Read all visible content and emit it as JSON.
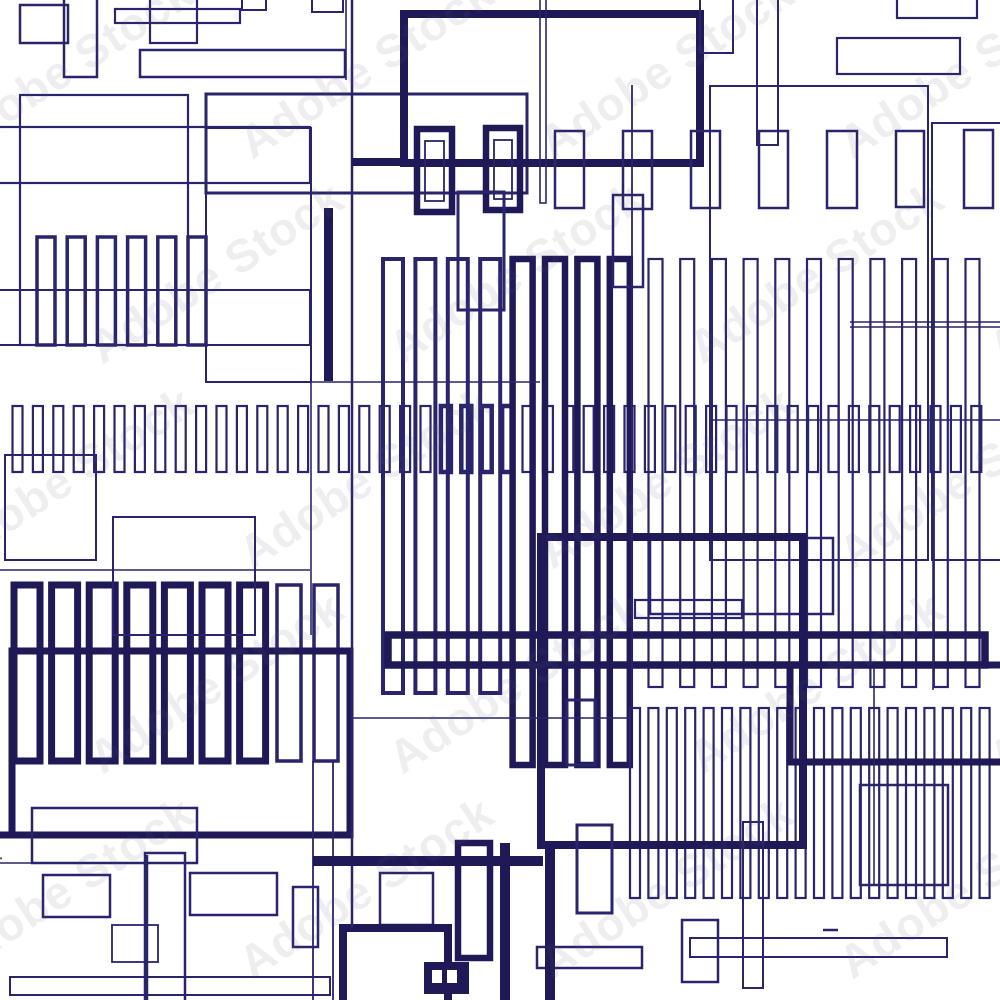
{
  "watermark": {
    "tile_text": "Adobe Stock",
    "credit_text": "Adobe Stock | #250414884"
  },
  "palette": {
    "background": "#ffffff",
    "ink_thin": "#29246b",
    "ink_bold": "#1f1a57",
    "watermark_gray": "#555558"
  },
  "figure": {
    "rects": [
      [
        20,
        5,
        48,
        38,
        2.5
      ],
      [
        64,
        -10,
        33,
        87,
        2.5
      ],
      [
        115,
        9,
        125,
        14,
        2.2
      ],
      [
        150,
        -10,
        47,
        53,
        2.2
      ],
      [
        242,
        -6,
        24,
        16,
        2
      ],
      [
        312,
        -6,
        31,
        18,
        2
      ],
      [
        140,
        50,
        205,
        27,
        2.5
      ],
      [
        20,
        95,
        168,
        250,
        2.2
      ],
      [
        -15,
        127,
        325,
        56,
        2.2
      ],
      [
        -15,
        290,
        325,
        55,
        2
      ],
      [
        206,
        94,
        321,
        99,
        3
      ],
      [
        206,
        128,
        105,
        254,
        2
      ],
      [
        404,
        14,
        296,
        149,
        8
      ],
      [
        417,
        129,
        35,
        83,
        6.5
      ],
      [
        425,
        141,
        19,
        60,
        1.8
      ],
      [
        486,
        128,
        34,
        82,
        6.5
      ],
      [
        494,
        140,
        18,
        59,
        1.8
      ],
      [
        555,
        131,
        29,
        77,
        2.5
      ],
      [
        623,
        131,
        29,
        78,
        2.5
      ],
      [
        691,
        131,
        29,
        77,
        2.5
      ],
      [
        759,
        131,
        29,
        77,
        2.5
      ],
      [
        827,
        131,
        30,
        77,
        2.5
      ],
      [
        896,
        131,
        28,
        76,
        2.5
      ],
      [
        964,
        130,
        29,
        78,
        2.5
      ],
      [
        458,
        192,
        46,
        118,
        3
      ],
      [
        613,
        195,
        30,
        92,
        2.5
      ],
      [
        700,
        -20,
        33,
        73,
        2
      ],
      [
        757,
        -20,
        21,
        165,
        2
      ],
      [
        897,
        -10,
        80,
        28,
        2.2
      ],
      [
        837,
        38,
        123,
        36,
        2.2
      ],
      [
        710,
        86,
        218,
        474,
        2
      ],
      [
        932,
        123,
        85,
        437,
        2
      ],
      [
        540,
        -20,
        6,
        223,
        1.6
      ],
      [
        5,
        455,
        91,
        105,
        2
      ],
      [
        113,
        517,
        142,
        118,
        2
      ],
      [
        650,
        538,
        183,
        76,
        2.5
      ],
      [
        635,
        600,
        107,
        18,
        2.2
      ],
      [
        541,
        537,
        262,
        308,
        8
      ],
      [
        388,
        635,
        597,
        30,
        7.5
      ],
      [
        790,
        665,
        225,
        97,
        7
      ],
      [
        567,
        700,
        28,
        65,
        3
      ],
      [
        860,
        785,
        88,
        100,
        2.5
      ],
      [
        12,
        651,
        338,
        184,
        7
      ],
      [
        32,
        808,
        165,
        55,
        2.5
      ],
      [
        145,
        853,
        40,
        155,
        2.5
      ],
      [
        43,
        875,
        67,
        42,
        2.5
      ],
      [
        112,
        925,
        46,
        37,
        1.8
      ],
      [
        190,
        873,
        87,
        42,
        2.5
      ],
      [
        293,
        887,
        25,
        60,
        2.5
      ],
      [
        10,
        977,
        320,
        18,
        2
      ],
      [
        380,
        873,
        53,
        52,
        2.5
      ],
      [
        343,
        928,
        105,
        80,
        8
      ],
      [
        458,
        843,
        32,
        115,
        6.5
      ],
      [
        577,
        825,
        35,
        88,
        3
      ],
      [
        537,
        947,
        105,
        21,
        2.5
      ],
      [
        682,
        920,
        36,
        62,
        2.5
      ],
      [
        743,
        822,
        20,
        166,
        2
      ],
      [
        690,
        938,
        257,
        19,
        2
      ]
    ],
    "filled": [
      [
        324,
        208,
        9,
        173
      ],
      [
        545,
        845,
        10,
        160
      ],
      [
        500,
        843,
        10,
        162
      ],
      [
        424,
        962,
        45,
        32
      ],
      [
        432,
        970,
        10,
        13,
        "#ffffff"
      ],
      [
        447,
        970,
        10,
        13,
        "#ffffff"
      ],
      [
        313,
        856,
        230,
        10
      ]
    ],
    "lines": [
      [
        352,
        0,
        352,
        928,
        2.5
      ],
      [
        346,
        0,
        346,
        80,
        1.6
      ],
      [
        311,
        183,
        311,
        635,
        1.6
      ],
      [
        311,
        382,
        540,
        382,
        1.6
      ],
      [
        0,
        570,
        310,
        570,
        1.6
      ],
      [
        352,
        718,
        630,
        718,
        1.6
      ],
      [
        632,
        85,
        632,
        710,
        1.8
      ],
      [
        933,
        560,
        933,
        690,
        1.6
      ],
      [
        713,
        420,
        1005,
        420,
        1.4
      ],
      [
        850,
        322,
        1005,
        322,
        1.4
      ],
      [
        850,
        327,
        1005,
        327,
        1.4
      ],
      [
        874,
        668,
        874,
        886,
        1.6
      ],
      [
        823,
        930,
        838,
        930,
        2.5
      ],
      [
        0,
        863,
        32,
        863,
        1.6
      ],
      [
        147,
        855,
        147,
        1005,
        2.5
      ],
      [
        313,
        761,
        313,
        1005,
        1.8
      ],
      [
        333,
        761,
        333,
        1005,
        1.8
      ],
      [
        0,
        835,
        12,
        835,
        7
      ],
      [
        352,
        162,
        404,
        162,
        8
      ]
    ],
    "combs": [
      {
        "x0": 37,
        "step": 30.2,
        "count": 6,
        "w": 18,
        "y": 237,
        "h": 108,
        "s": 3.5
      },
      {
        "x0": 12.5,
        "step": 20.4,
        "count": 48,
        "w": 10,
        "y": 406,
        "h": 66,
        "s": 2.2,
        "solid": [
          21,
          22,
          23,
          24
        ],
        "solidS": 4.5
      },
      {
        "x0": 383,
        "step": 32.4,
        "count": 4,
        "w": 20,
        "y": 259,
        "h": 434,
        "s": 4
      },
      {
        "x0": 512.6,
        "step": 32.4,
        "count": 4,
        "w": 20,
        "y": 259,
        "h": 506,
        "s": 6.5
      },
      {
        "x0": 648.5,
        "step": 31.7,
        "count": 11,
        "w": 14,
        "y": 259,
        "h": 428,
        "s": 2.2
      },
      {
        "x0": 630,
        "step": 18.4,
        "count": 20,
        "w": 10,
        "y": 708,
        "h": 190,
        "s": 2.2
      },
      {
        "x0": 14,
        "step": 37.6,
        "count": 7,
        "w": 26,
        "y": 585,
        "h": 176,
        "s": 7
      },
      {
        "x0": 277,
        "step": 37,
        "count": 2,
        "w": 24,
        "y": 585,
        "h": 176,
        "s": 3.5
      }
    ]
  }
}
